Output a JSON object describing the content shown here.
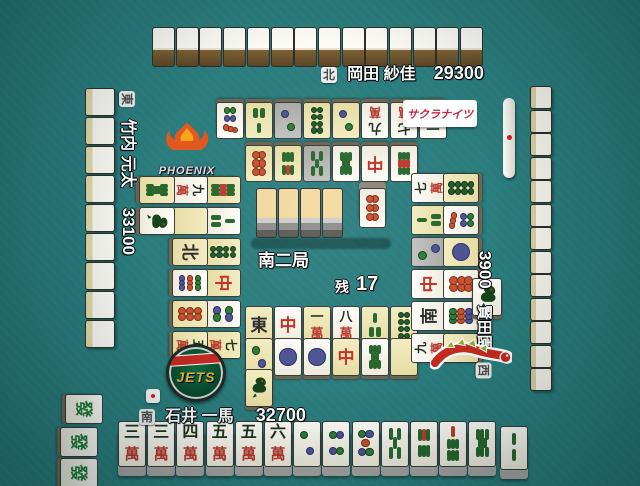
{
  "table": {
    "felt": "#2a7c7d",
    "round": "南二局",
    "remaining_label": "残",
    "remaining": "17"
  },
  "players": {
    "top": {
      "seat": "北",
      "name": "岡田 紗佳",
      "score": "29300",
      "wall_tiles": 14
    },
    "left": {
      "seat": "東",
      "name": "竹内 元太",
      "score": "33100",
      "wall_tiles": 9
    },
    "right": {
      "seat": "西",
      "name": "園田 賢",
      "score": "3900",
      "wall_tiles": 13
    },
    "bottom": {
      "seat": "南",
      "name": "石井 一馬",
      "score": "32700"
    }
  },
  "logos": {
    "phoenix": "PHOENIX",
    "sakura_knights": "サクラナイツ",
    "jets": "JETS"
  },
  "dead_wall": {
    "back_tiles": 4,
    "dora_indicator": "6p"
  },
  "rivers": {
    "top": [
      [
        "6p|y",
        "6s|y",
        "5s|g",
        "8s",
        "Rd",
        "9s"
      ],
      [
        "7p",
        "3s|y",
        "2p|g",
        "8p|y",
        "2p|y",
        "9m",
        "7m",
        "1m"
      ]
    ],
    "left": [
      [
        "9s|y",
        "3s",
        "8p|y",
        "Rd|y",
        "4p",
        "7m|y"
      ],
      [
        "9m",
        "Wh|y",
        "N|y",
        "9p",
        "6p|y",
        "5m|y"
      ],
      [
        "8s|y",
        "1s"
      ]
    ],
    "right": [
      [
        "7m",
        "3s|y",
        "2p|g",
        "Rd",
        "S",
        "9m"
      ],
      [
        "8p|y",
        "7p",
        "1p|y",
        "6p",
        "9p",
        "7m|y"
      ]
    ],
    "bottom": [
      [
        "E|y",
        "Rd",
        "1m|y",
        "8m",
        "3s|y",
        "8p|y"
      ],
      [
        "2p|y",
        "1p",
        "1p",
        "Rd|y",
        "8s",
        "Wh|y"
      ],
      [
        "1s|y"
      ]
    ]
  },
  "right_riichi_tile": "1s",
  "left_meld": [
    "Gr",
    "Gr",
    "Gr"
  ],
  "hand": {
    "tiles": [
      "3m",
      "3m",
      "4m",
      "5m",
      "5m",
      "6m",
      "2p",
      "4p",
      "5p",
      "5s",
      "6s",
      "7s",
      "8s"
    ],
    "drawn": "2s"
  },
  "markers": {
    "right_riichi_stick": true,
    "bottom_stick_marker": true
  }
}
